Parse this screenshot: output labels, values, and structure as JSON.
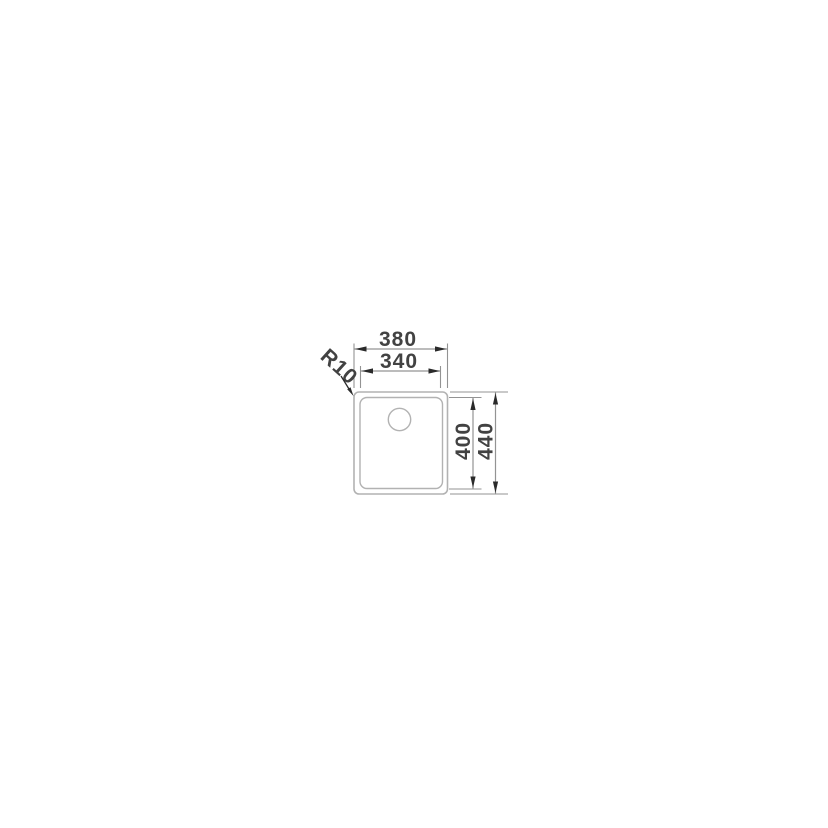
{
  "page": {
    "background": "#ffffff"
  },
  "diagram": {
    "name": "sink-dimension-drawing",
    "colors": {
      "background": "#ffffff",
      "outline": "#b2b2b2",
      "dim_line": "#939393",
      "arrowhead": "#2a2a2a",
      "label": "#424242"
    },
    "labels": {
      "outer_width": "380",
      "inner_width": "340",
      "inner_depth": "400",
      "outer_depth": "440",
      "corner_radius": "R10"
    },
    "dimensions_mm": {
      "outer_width": 380,
      "inner_width": 340,
      "inner_depth": 400,
      "outer_depth": 440,
      "corner_radius": 10
    }
  }
}
